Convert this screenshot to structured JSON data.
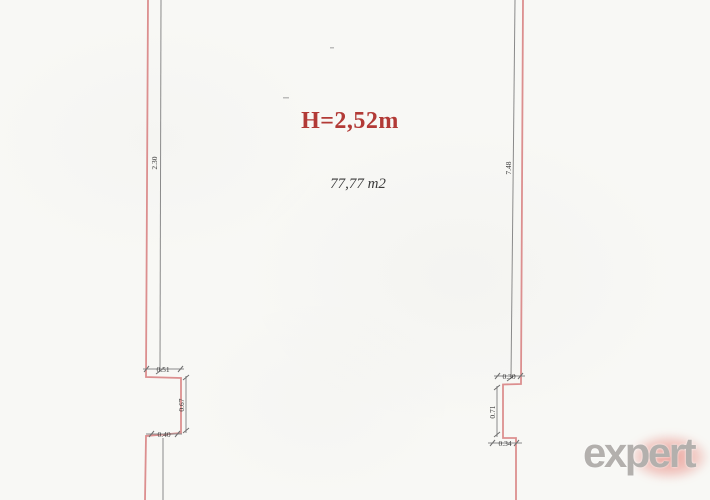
{
  "plan": {
    "height_label": "H=2,52m",
    "area_label": "77,77 m2"
  },
  "dims": {
    "left_wall": "2.30",
    "right_wall": "7.48",
    "left_notch_width": "0.51",
    "left_notch_depth": "0.67",
    "left_notch_bottom": "0.40",
    "right_notch_width": "0.30",
    "right_notch_depth": "0.71",
    "right_notch_bottom": "0.34"
  },
  "logo": {
    "text": "expert"
  },
  "colors": {
    "wall": "#dc8f8f",
    "dimension_line": "#8a8a8a",
    "height_text": "#b23a36",
    "area_text": "#3a3a3a",
    "logo_text": "#b3b0ad",
    "logo_glow": "#e0584c",
    "paper": "#f8f8f5"
  }
}
